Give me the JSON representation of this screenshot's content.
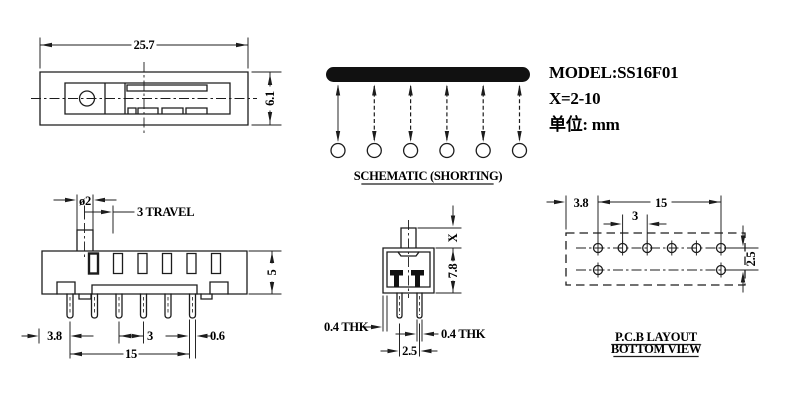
{
  "title_block": {
    "model": "MODEL:SS16F01",
    "x_range": "X=2-10",
    "unit": "单位: mm"
  },
  "top_view": {
    "width": "25.7",
    "height": "6.1"
  },
  "schematic": {
    "label": "SCHEMATIC (SHORTING)",
    "positions": 6
  },
  "front_view": {
    "knob_dia": "ø2",
    "travel": "3 TRAVEL",
    "height": "5",
    "left_offset": "3.8",
    "pitch": "3",
    "pin_width": "0.6",
    "span": "15"
  },
  "side_view": {
    "knob_height": "X",
    "body_height": "7.8",
    "wall_thk": "0.4 THK",
    "pin_thk": "0.4 THK",
    "pin_pitch": "2.5"
  },
  "pcb_view": {
    "left_offset": "3.8",
    "span": "15",
    "pitch": "3",
    "row_pitch": "2.5",
    "label1": "P.C.B LAYOUT",
    "label2": "BOTTOM VIEW"
  },
  "colors": {
    "line": "#1c1c1c",
    "background": "#ffffff"
  }
}
